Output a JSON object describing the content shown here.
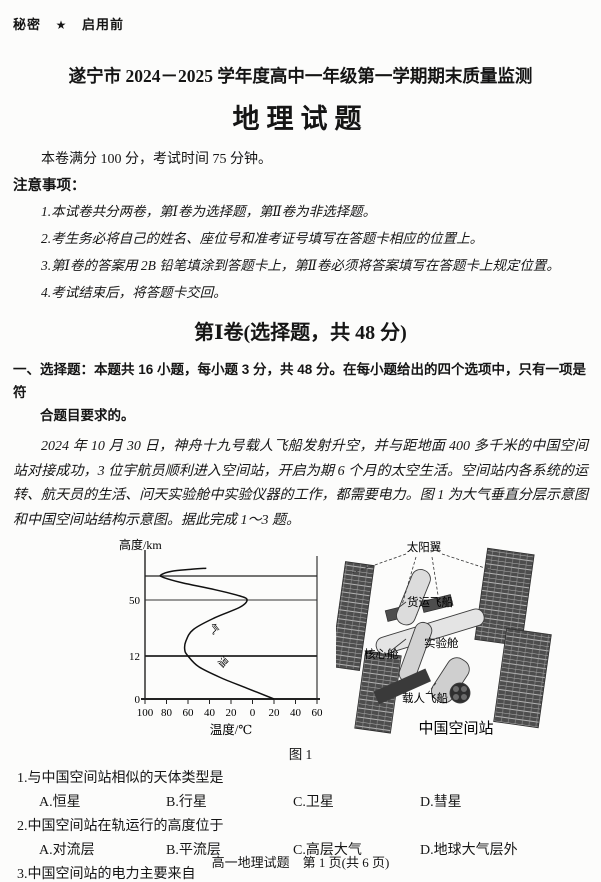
{
  "header": {
    "classification": "秘密",
    "star": "★",
    "stage": "启用前",
    "title": "遂宁市 2024－2025 学年度高中一年级第一学期期末质量监测",
    "subject": "地理试题"
  },
  "exam_info": "本卷满分 100 分，考试时间 75 分钟。",
  "notes": {
    "heading": "注意事项：",
    "items": [
      "1.本试卷共分两卷，第Ⅰ卷为选择题，第Ⅱ卷为非选择题。",
      "2.考生务必将自己的姓名、座位号和准考证号填写在答题卡相应的位置上。",
      "3.第Ⅰ卷的答案用 2B 铅笔填涂到答题卡上，第Ⅱ卷必须将答案填写在答题卡上规定位置。",
      "4.考试结束后，将答题卡交回。"
    ]
  },
  "section1": {
    "title": "第Ⅰ卷(选择题，共 48 分)",
    "intro_line1": "一、选择题：本题共 16 小题，每小题 3 分，共 48 分。在每小题给出的四个选项中，只有一项是符",
    "intro_line2": "合题目要求的。"
  },
  "passage": "2024 年 10 月 30 日，神舟十九号载人飞船发射升空，并与距地面 400 多千米的中国空间站对接成功，3 位宇航员顺利进入空间站，开启为期 6 个月的太空生活。空间站内各系统的运转、航天员的生活、问天实验舱中实验仪器的工作，都需要电力。图 1 为大气垂直分层示意图和中国空间站结构示意图。据此完成 1～3 题。",
  "chart_data": {
    "type": "line",
    "title": "大气垂直分层示意图",
    "xlabel": "温度/℃",
    "ylabel": "高度/km",
    "x_range": [
      -100,
      60
    ],
    "x_tick_values": [
      -100,
      -80,
      -60,
      -40,
      -20,
      0,
      20,
      40,
      60
    ],
    "x_tick_labels": [
      "100",
      "80",
      "60",
      "40",
      "20",
      "0",
      "20",
      "40",
      "60"
    ],
    "y_range_km": [
      0,
      95
    ],
    "y_tick_labels": [
      "0",
      "12",
      "50"
    ],
    "y_tick_values_km": [
      0,
      12,
      50
    ],
    "layer_boundaries_km": [
      12,
      50,
      85
    ],
    "grid": "horizontal-only",
    "curve_label": "气温",
    "curve_label_chars": [
      "气",
      "温"
    ],
    "series": [
      {
        "name": "气温",
        "points": [
          [
            20,
            0
          ],
          [
            -5,
            3
          ],
          [
            -30,
            6
          ],
          [
            -50,
            9
          ],
          [
            -60,
            12
          ],
          [
            -63,
            16
          ],
          [
            -62,
            22
          ],
          [
            -55,
            30
          ],
          [
            -35,
            38
          ],
          [
            -12,
            45
          ],
          [
            -5,
            50
          ],
          [
            -12,
            56
          ],
          [
            -35,
            65
          ],
          [
            -65,
            75
          ],
          [
            -83,
            83
          ],
          [
            -85,
            86
          ],
          [
            -75,
            89
          ],
          [
            -58,
            90.5
          ],
          [
            -43,
            91.5
          ]
        ]
      }
    ]
  },
  "figure": {
    "caption": "图 1",
    "station_caption": "中国空间站",
    "station_labels": {
      "solar_wing": "太阳翼",
      "cargo": "货运飞船",
      "lab": "实验舱",
      "core": "核心舱",
      "crew": "载人飞船"
    }
  },
  "questions": [
    {
      "number": "1.",
      "stem": "与中国空间站相似的天体类型是",
      "options": [
        "A.恒星",
        "B.行星",
        "C.卫星",
        "D.彗星"
      ]
    },
    {
      "number": "2.",
      "stem": "中国空间站在轨运行的高度位于",
      "options": [
        "A.对流层",
        "B.平流层",
        "C.高层大气",
        "D.地球大气层外"
      ]
    },
    {
      "number": "3.",
      "stem": "中国空间站的电力主要来自",
      "options": [
        "A.太阳辐射",
        "B.核电站",
        "C.锂电池",
        "D.宇宙射线"
      ]
    }
  ],
  "footer": "高一地理试题　第 1 页(共 6 页)"
}
